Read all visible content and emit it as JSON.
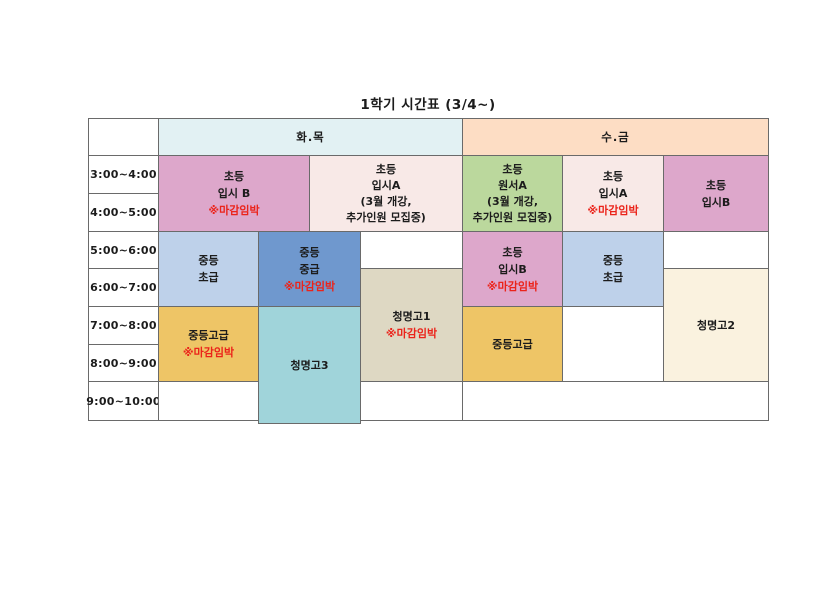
{
  "title": "1학기 시간표 (3/4~)",
  "palette": {
    "white": "#ffffff",
    "header_tue_thu": "#e2f1f3",
    "header_wed_fri": "#fdddc4",
    "pink": "#dda7cb",
    "blush": "#f8e9e7",
    "green": "#bbd89d",
    "light_blue": "#bed1ea",
    "blue": "#6f98ce",
    "gold": "#eec566",
    "tan": "#ded8c3",
    "teal": "#a0d4da",
    "cream": "#faf2df",
    "alert_red": "#eb231a"
  },
  "table": {
    "day_groups": [
      {
        "label": "화.목"
      },
      {
        "label": "수.금"
      }
    ],
    "time_slots": [
      "3:00~4:00",
      "4:00~5:00",
      "5:00~6:00",
      "6:00~7:00",
      "7:00~8:00",
      "8:00~9:00",
      "9:00~10:00"
    ],
    "classes": {
      "tt_elem_exam_b": {
        "label": "초등\n입시 B",
        "alert": "※마감임박"
      },
      "tt_elem_exam_a": {
        "label": "초등\n입시A\n(3월 개강,\n추가인원 모집중)"
      },
      "tt_mid_beginner": {
        "label": "중등\n초급"
      },
      "tt_mid_intermediate": {
        "label": "중등\n중급",
        "alert": "※마감임박"
      },
      "tt_cheongmyeong1": {
        "label": "청명고1",
        "alert": "※마감임박"
      },
      "tt_mid_advanced": {
        "label": "중등고급",
        "alert": "※마감임박"
      },
      "tt_cheongmyeong3": {
        "label": "청명고3"
      },
      "wf_elem_wonseo_a": {
        "label": "초등\n원서A\n(3월 개강,\n추가인원 모집중)"
      },
      "wf_elem_exam_a": {
        "label": "초등\n입시A",
        "alert": "※마감임박"
      },
      "wf_elem_exam_b_top": {
        "label": "초등\n입시B"
      },
      "wf_elem_exam_b": {
        "label": "초등\n입시B",
        "alert": "※마감임박"
      },
      "wf_mid_beginner": {
        "label": "중등\n초급"
      },
      "wf_cheongmyeong2": {
        "label": "청명고2"
      },
      "wf_mid_advanced": {
        "label": "중등고급"
      }
    }
  }
}
